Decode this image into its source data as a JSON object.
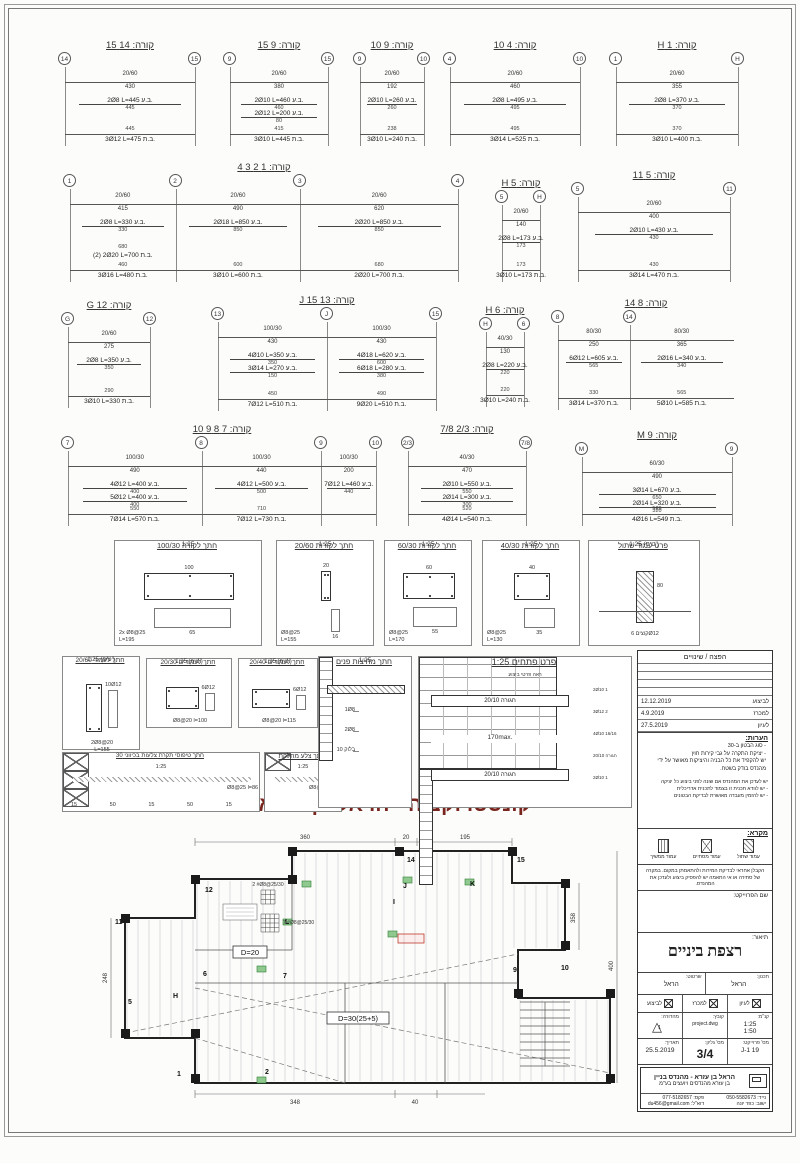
{
  "red_title": "קונסטרוקציה - הראל בן עזרא",
  "red_color": "#7a241e",
  "beams": [
    {
      "title": "קורה: 14 15",
      "grids": [
        "14",
        "15"
      ],
      "spans": [
        {
          "dim": "20/60",
          "len": "430"
        }
      ],
      "top": [
        {
          "label": "2Ø8 L=445 ב.ע.",
          "len": "445"
        }
      ],
      "bottom": [
        {
          "len": "445",
          "label": "3Ø12 L=475 ב.ת."
        }
      ]
    },
    {
      "title": "קורה: 9 15",
      "grids": [
        "9",
        "15"
      ],
      "spans": [
        {
          "dim": "20/60",
          "len": "380"
        }
      ],
      "top": [
        {
          "label": "2Ø10 L=460 ב.ע.",
          "len": "460"
        },
        {
          "label": "2Ø12 L=200 ב.ע.",
          "len": "80"
        }
      ],
      "bottom": [
        {
          "len": "415",
          "label": "3Ø10 L=445 ב.ת."
        }
      ]
    },
    {
      "title": "קורה: 9 10",
      "grids": [
        "9",
        "10"
      ],
      "spans": [
        {
          "dim": "20/60",
          "len": "192"
        }
      ],
      "top": [
        {
          "label": "2Ø10 L=260 ב.ע.",
          "len": "260"
        }
      ],
      "bottom": [
        {
          "len": "238",
          "label": "3Ø10 L=240 ב.ת."
        }
      ]
    },
    {
      "title": "קורה: 4 10",
      "grids": [
        "4",
        "10"
      ],
      "spans": [
        {
          "dim": "20/60",
          "len": "460"
        }
      ],
      "top": [
        {
          "label": "2Ø8 L=495 ב.ע.",
          "len": "495"
        }
      ],
      "bottom": [
        {
          "len": "495",
          "label": "3Ø14 L=525 ב.ת."
        }
      ]
    },
    {
      "title": "קורה: 1 H",
      "grids": [
        "1",
        "H"
      ],
      "spans": [
        {
          "dim": "20/60",
          "len": "355"
        }
      ],
      "top": [
        {
          "label": "2Ø8 L=370 ב.ע.",
          "len": "370"
        }
      ],
      "bottom": [
        {
          "len": "370",
          "label": "3Ø10 L=400 ב.ת."
        }
      ]
    },
    {
      "title": "קורה: 1 2 3 4",
      "grids": [
        "1",
        "2",
        "3",
        "4"
      ],
      "spans": [
        {
          "dim": "20/60",
          "len": "415"
        },
        {
          "dim": "20/60",
          "len": "490"
        },
        {
          "dim": "20/60",
          "len": "620"
        }
      ],
      "top": [
        {
          "label": "2Ø8 L=330 ב.ע.",
          "len": "330"
        },
        {
          "label": "2Ø18 L=850 ב.ע.",
          "len": "850"
        },
        {
          "label": "2Ø20 L=850 ב.ע.",
          "len": "850"
        }
      ],
      "bottom": [
        {
          "len": "460",
          "label": "3Ø16 L=480 ב.ת."
        },
        {
          "len": "600",
          "label": "3Ø10 L=600 ב.ת."
        },
        {
          "len": "680",
          "label": "2Ø20 L=700 ב.ת."
        },
        {
          "len": "680",
          "label": "(2) 2Ø20 L=700 ב.ת."
        }
      ]
    },
    {
      "title": "קורה: 5 H",
      "grids": [
        "5",
        "H"
      ],
      "spans": [
        {
          "dim": "20/60",
          "len": "140"
        }
      ],
      "top": [
        {
          "label": "2Ø8 L=173 ב.ע.",
          "len": "173"
        }
      ],
      "bottom": [
        {
          "len": "173",
          "label": "3Ø10 L=173 ב.ת."
        }
      ]
    },
    {
      "title": "קורה: 5 11",
      "grids": [
        "5",
        "11"
      ],
      "spans": [
        {
          "dim": "20/60",
          "len": "400"
        }
      ],
      "top": [
        {
          "label": "2Ø10 L=430 ב.ע.",
          "len": "430"
        }
      ],
      "bottom": [
        {
          "len": "430",
          "label": "3Ø14 L=470 ב.ת."
        }
      ]
    },
    {
      "title": "קורה: G 12",
      "grids": [
        "G",
        "12"
      ],
      "spans": [
        {
          "dim": "20/60",
          "len": "275"
        }
      ],
      "top": [
        {
          "label": "2Ø8 L=350 ב.ע.",
          "len": "350"
        }
      ],
      "bottom": [
        {
          "len": "290",
          "label": "3Ø10 L=330 ב.ת."
        }
      ]
    },
    {
      "title": "קורה: 13 J 15",
      "grids": [
        "13",
        "J",
        "15"
      ],
      "spans": [
        {
          "dim": "100/30",
          "len": "430"
        },
        {
          "dim": "100/30",
          "len": "430"
        }
      ],
      "top": [
        {
          "label": "4Ø10 L=350 ב.ע.",
          "len": "350"
        },
        {
          "label": "4Ø18 L=620 ב.ע.",
          "len": "600"
        },
        {
          "label": "3Ø14 L=270 ב.ע.",
          "len": "150"
        },
        {
          "label": "6Ø18 L=280 ב.ע.",
          "len": "380"
        }
      ],
      "bottom": [
        {
          "len": "450",
          "label": "7Ø12 L=510 ב.ת."
        },
        {
          "len": "490",
          "label": "9Ø20 L=510 ב.ת."
        }
      ]
    },
    {
      "title": "קורה: H 6",
      "grids": [
        "H",
        "6"
      ],
      "spans": [
        {
          "dim": "40/30",
          "len": "130"
        }
      ],
      "top": [
        {
          "label": "2Ø8 L=220 ב.ע.",
          "len": "220"
        }
      ],
      "bottom": [
        {
          "len": "220",
          "label": "3Ø10 L=240 ב.ת."
        }
      ]
    },
    {
      "title": "קורה: 8 14",
      "grids": [
        "8",
        "14"
      ],
      "spans": [
        {
          "dim": "80/30",
          "len": "250"
        },
        {
          "dim": "80/30",
          "len": "365"
        }
      ],
      "top": [
        {
          "label": "6Ø12 L=605 ב.ע.",
          "len": "565"
        },
        {
          "label": "2Ø16 L=340 ב.ע.",
          "len": "340"
        }
      ],
      "bottom": [
        {
          "len": "330",
          "label": "3Ø14 L=370 ב.ת."
        },
        {
          "len": "565",
          "label": "5Ø10 L=585 ב.ת."
        }
      ]
    },
    {
      "title": "קורה: 7 8 9 10",
      "grids": [
        "7",
        "8",
        "9",
        "10"
      ],
      "spans": [
        {
          "dim": "100/30",
          "len": "490"
        },
        {
          "dim": "100/30",
          "len": "440"
        },
        {
          "dim": "100/30",
          "len": "200"
        }
      ],
      "top": [
        {
          "label": "4Ø12 L=400 ב.ע.",
          "len": "400"
        },
        {
          "label": "4Ø12 L=500 ב.ע.",
          "len": "500"
        },
        {
          "label": "7Ø12 L=460 ב.ע.",
          "len": "440"
        },
        {
          "label": "5Ø12 L=400 ב.ע.",
          "len": "400"
        }
      ],
      "bottom": [
        {
          "len": "550",
          "label": "7Ø14 L=570 ב.ת."
        },
        {
          "len": "710",
          "label": "7Ø12 L=730 ב.ת."
        }
      ]
    },
    {
      "title": "קורה: 2/3 7/8",
      "grids": [
        "2/3",
        "7/8"
      ],
      "spans": [
        {
          "dim": "40/30",
          "len": "470"
        }
      ],
      "top": [
        {
          "label": "2Ø10 L=550 ב.ע.",
          "len": "550"
        },
        {
          "label": "2Ø14 L=300 ב.ע.",
          "len": "300"
        }
      ],
      "bottom": [
        {
          "len": "520",
          "label": "4Ø14 L=540 ב.ת."
        }
      ]
    },
    {
      "title": "קורה: M 9",
      "grids": [
        "M",
        "9"
      ],
      "spans": [
        {
          "dim": "60/30",
          "len": "490"
        }
      ],
      "top": [
        {
          "label": "3Ø14 L=670 ב.ע.",
          "len": "650"
        },
        {
          "label": "2Ø14 L=320 ב.ע.",
          "len": "320"
        }
      ],
      "bottom": [
        {
          "len": "529",
          "label": "4Ø16 L=549 ב.ת."
        }
      ]
    }
  ],
  "sections": [
    {
      "title": "חתך לקורה 100/30",
      "scale": "1:25",
      "stirrup": "2x Ø8@25\nL=195",
      "size": [
        100,
        30
      ],
      "dims": [
        "100",
        "65"
      ]
    },
    {
      "title": "חתך לקורות 20/60",
      "scale": "1:25",
      "stirrup": "Ø8@25\nL=155",
      "size": [
        20,
        60
      ],
      "dims": [
        "20",
        "16"
      ]
    },
    {
      "title": "חתך לקורות 60/30",
      "scale": "1:25",
      "stirrup": "Ø8@25\nL=170",
      "size": [
        60,
        30
      ],
      "dims": [
        "60",
        "55"
      ]
    },
    {
      "title": "חתך לקורות 40/30",
      "scale": "1:25",
      "stirrup": "Ø8@25\nL=130",
      "size": [
        40,
        30
      ],
      "dims": [
        "40",
        "35"
      ]
    },
    {
      "title": "פרט עמוד שתול",
      "scale": "1:25 (טיפ')",
      "stirrup": "קוצים 6Ø12",
      "size": [
        20,
        80
      ],
      "dims": [
        "80",
        "20"
      ]
    }
  ],
  "col_sections": [
    {
      "title": "חתך לעמוד 20/60",
      "scale": "1:25 (טיפ')",
      "bars": "10Ø12",
      "stirrup": "2Ø8@20\nL=155",
      "size": [
        20,
        60
      ]
    },
    {
      "title": "חתך לעמודים 20/30",
      "scale": "1:25 (טיפ')",
      "bars": "6Ø12",
      "stirrup": "Ø8@20 l=100",
      "size": [
        30,
        20
      ]
    },
    {
      "title": "חתך לעמודים 20/40",
      "scale": "1:25 (טיפ')",
      "bars": "6Ø12",
      "stirrup": "Ø8@20 l=115",
      "size": [
        40,
        20
      ]
    }
  ],
  "slab_sections": [
    {
      "title": "חתך טיפוסי תקרת צלעות בכיווני 30",
      "scale": "1:25",
      "stirrup": "Ø8@25 l=86",
      "dims": [
        "15",
        "50",
        "15",
        "50",
        "15"
      ]
    },
    {
      "title": "חתך צלע מחלקת",
      "scale": "1:25",
      "stirrup": "Ø8@25 l=95",
      "dims": []
    }
  ],
  "partition": {
    "title": "חתך מחיצות פנים",
    "scale": "1:25",
    "labels": [
      "1Ø8",
      "2Ø8",
      "בלוק 10"
    ]
  },
  "openings": {
    "title": "פרט פתחים 1:25",
    "subtitle": "ראה פרטי ביצוע",
    "band_top": "חגורה 20/10",
    "band_bottom": "חגורה 20/10",
    "mid": "170max.",
    "side_labels": [
      "2Ø10 1",
      "3Ø12 2",
      "4Ø10 16/16",
      "חגורה 20/10",
      "2Ø10 1"
    ]
  },
  "plan": {
    "grids": [
      "11",
      "12",
      "14",
      "15",
      "5",
      "6",
      "7",
      "9",
      "10",
      "1",
      "2",
      "H",
      "J",
      "K",
      "L",
      "I"
    ],
    "box_labels": {
      "d20": "D=20",
      "d30": "D=30(25+5)"
    },
    "mesh1": "2 #Ø8@25/30",
    "mesh2": "7 #Ø8@25/30",
    "dims": {
      "top1": "360",
      "top2": "20",
      "top3": "195",
      "bottom1": "348",
      "bottom2": "40",
      "left1": "248",
      "right1": "358",
      "right2": "400"
    }
  },
  "titleblock": {
    "revisions_header": "הפצה / שינויים",
    "revisions": [
      {
        "date": "12.12.2019",
        "label": "לביצוע"
      },
      {
        "date": "4.9.2019",
        "label": "למכרז"
      },
      {
        "date": "27.5.2019",
        "label": "לעיון"
      }
    ],
    "notes_title": "הערות:",
    "notes": [
      "- סוג הבטון ב-30",
      "- יציקת התקרה על גבי קירות חוץ",
      "יש להקפיד את כל הבניה והיציקות מאושר על ידי מהנדס בודק בשטח."
    ],
    "notes2": [
      "יש לעדכן את המהנדס אם שונה לפני ביצוע כל יציקה",
      "- יש לוודא תכנית זו בצמוד לתכנית אדריכלית",
      "- יש להזמין מעבדה מאושרת לבדיקת הבטונים"
    ],
    "legend_title": "מקרא:",
    "legend": [
      "עמוד שתול",
      "עמוד מסתיים",
      "עמוד ממשיך"
    ],
    "contractor_note": "הקבלן אחראי לבדיקת המידות ולהתאמתן במקום. במקרה של סתירה או אי התאמה יש להפסיק ביצוע ולעדכן את המהנדס.",
    "project_name_label": "שם הפרוייקט:",
    "description_label": "תיאור:",
    "description": "רצפת ביניים",
    "planner_label": "תכנון:",
    "planner": "הראל",
    "drafter_label": "שרטוט:",
    "drafter": "הראל",
    "checkboxes": [
      "לעיון",
      "למכרז",
      "לביצוע"
    ],
    "scale_label": "קנ\"מ:",
    "scale": "1:25\n1:50",
    "file_label": "קובץ:",
    "file": "project.dwg",
    "edition_label": "מהדורה:",
    "edition": "1",
    "project_no_label": "מס' פרוייקט:",
    "project_no": "19 J-1",
    "sheet_label": "מס' גליון:",
    "sheet": "3/4",
    "date_label": "תאריך:",
    "date": "25.5.2019",
    "company_line1": "הראל בן עזרא - מהנדס בניין",
    "company_line2": "בן עזרא מהנדסים ויועצים בע\"מ",
    "phone_mobile": "נייד: 050-5582673",
    "phone_office": "פקס: 077-5182657",
    "city": "ישוב: כפר יונה",
    "email": "דוא\"ל: du456@gmail.com"
  }
}
